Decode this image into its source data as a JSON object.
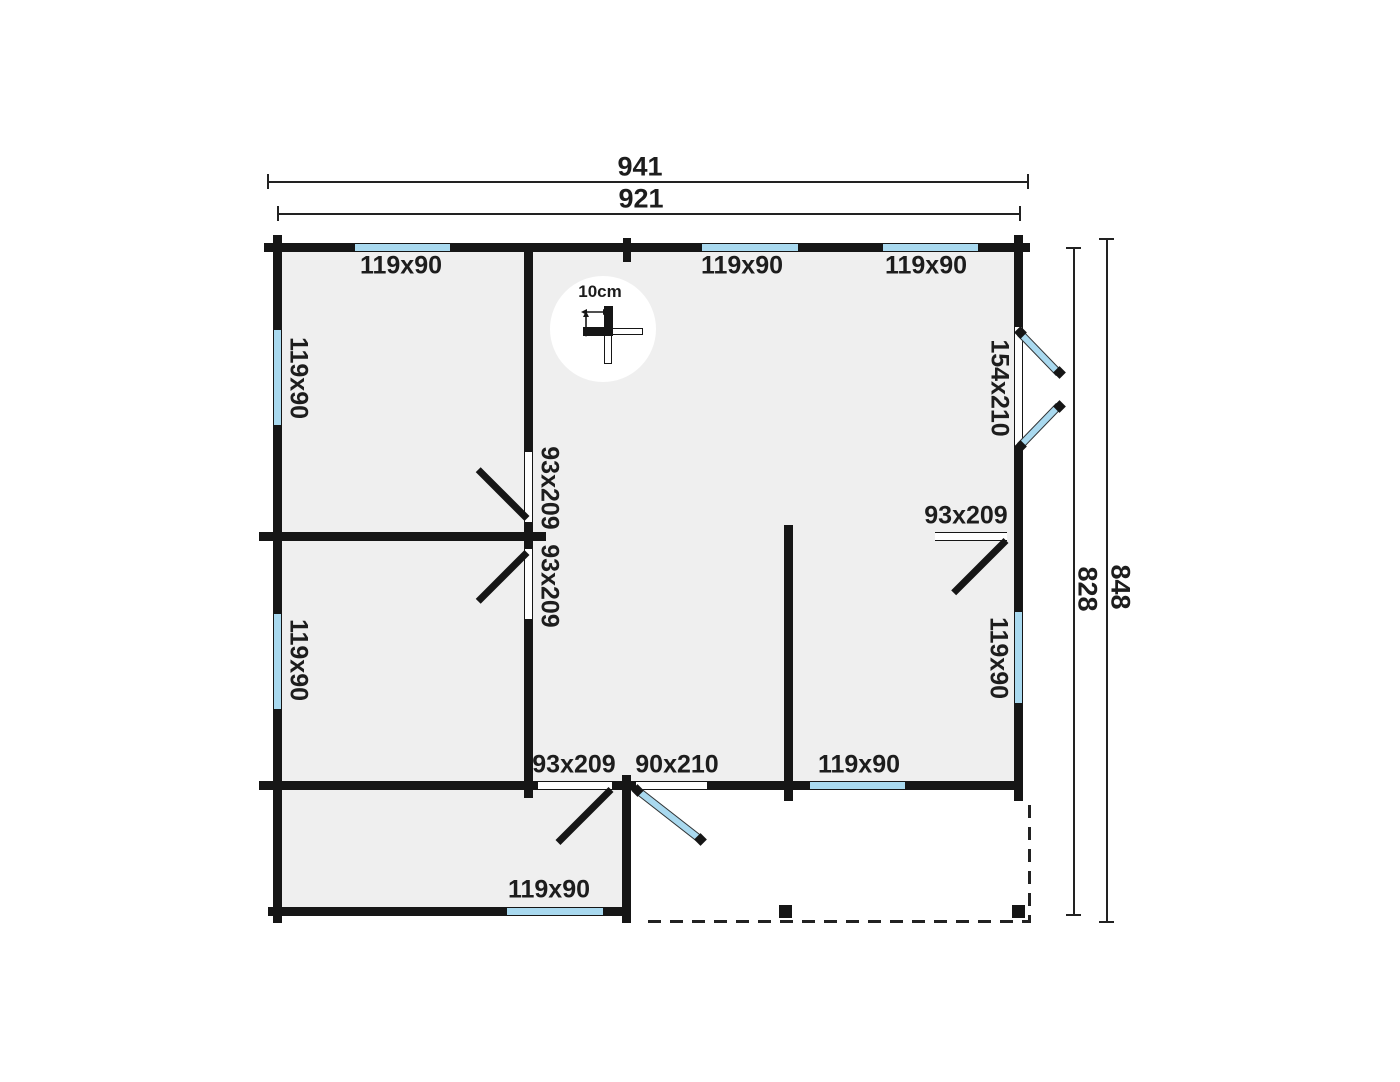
{
  "dimensions": {
    "width_outer": "941",
    "width_inner": "921",
    "height_outer": "848",
    "height_inner": "828"
  },
  "scale_indicator": {
    "label": "10cm"
  },
  "openings": {
    "window_top_left": "119x90",
    "window_top_middle": "119x90",
    "window_top_right": "119x90",
    "window_left_upper": "119x90",
    "window_left_lower": "119x90",
    "window_right_side": "119x90",
    "window_bottom_right_room": "119x90",
    "window_bottom_left_room": "119x90",
    "door_double_right": "154x210",
    "door_hall_upper": "93x209",
    "door_hall_lower": "93x209",
    "door_room_right": "93x209",
    "door_interior_bottom": "93x209",
    "door_entrance": "90x210"
  },
  "colors": {
    "wall": "#161616",
    "window": "#a9d9ef",
    "room_fill": "#efefef",
    "background": "#ffffff",
    "ink": "#1d1d1d"
  }
}
